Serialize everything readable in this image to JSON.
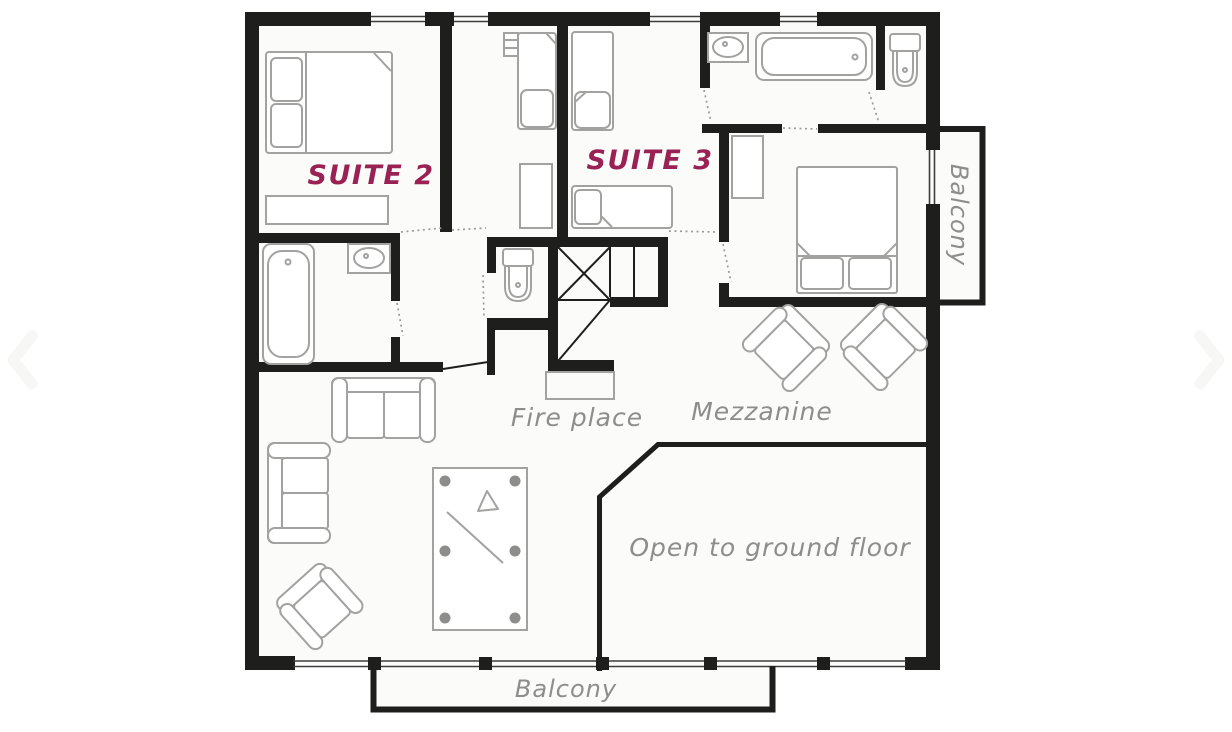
{
  "colors": {
    "wall": "#1e1e1c",
    "floor": "#fbfbf9",
    "furniture-outline": "#a2a2a0",
    "pocket": "#8d8d8b",
    "suite-label": "#9a2153",
    "gray-label": "#8d8d8b",
    "dots": "#9b9b99",
    "chevron": "#f7f7f5"
  },
  "labels": {
    "suite2": "SUITE 2",
    "suite3": "SUITE 3",
    "fireplace": "Fire place",
    "mezzanine": "Mezzanine",
    "open_to_ground_floor": "Open to ground floor",
    "balcony_right": "Balcony",
    "balcony_bottom": "Balcony"
  },
  "icons": {
    "prev": "chevron-left-icon",
    "next": "chevron-right-icon"
  }
}
